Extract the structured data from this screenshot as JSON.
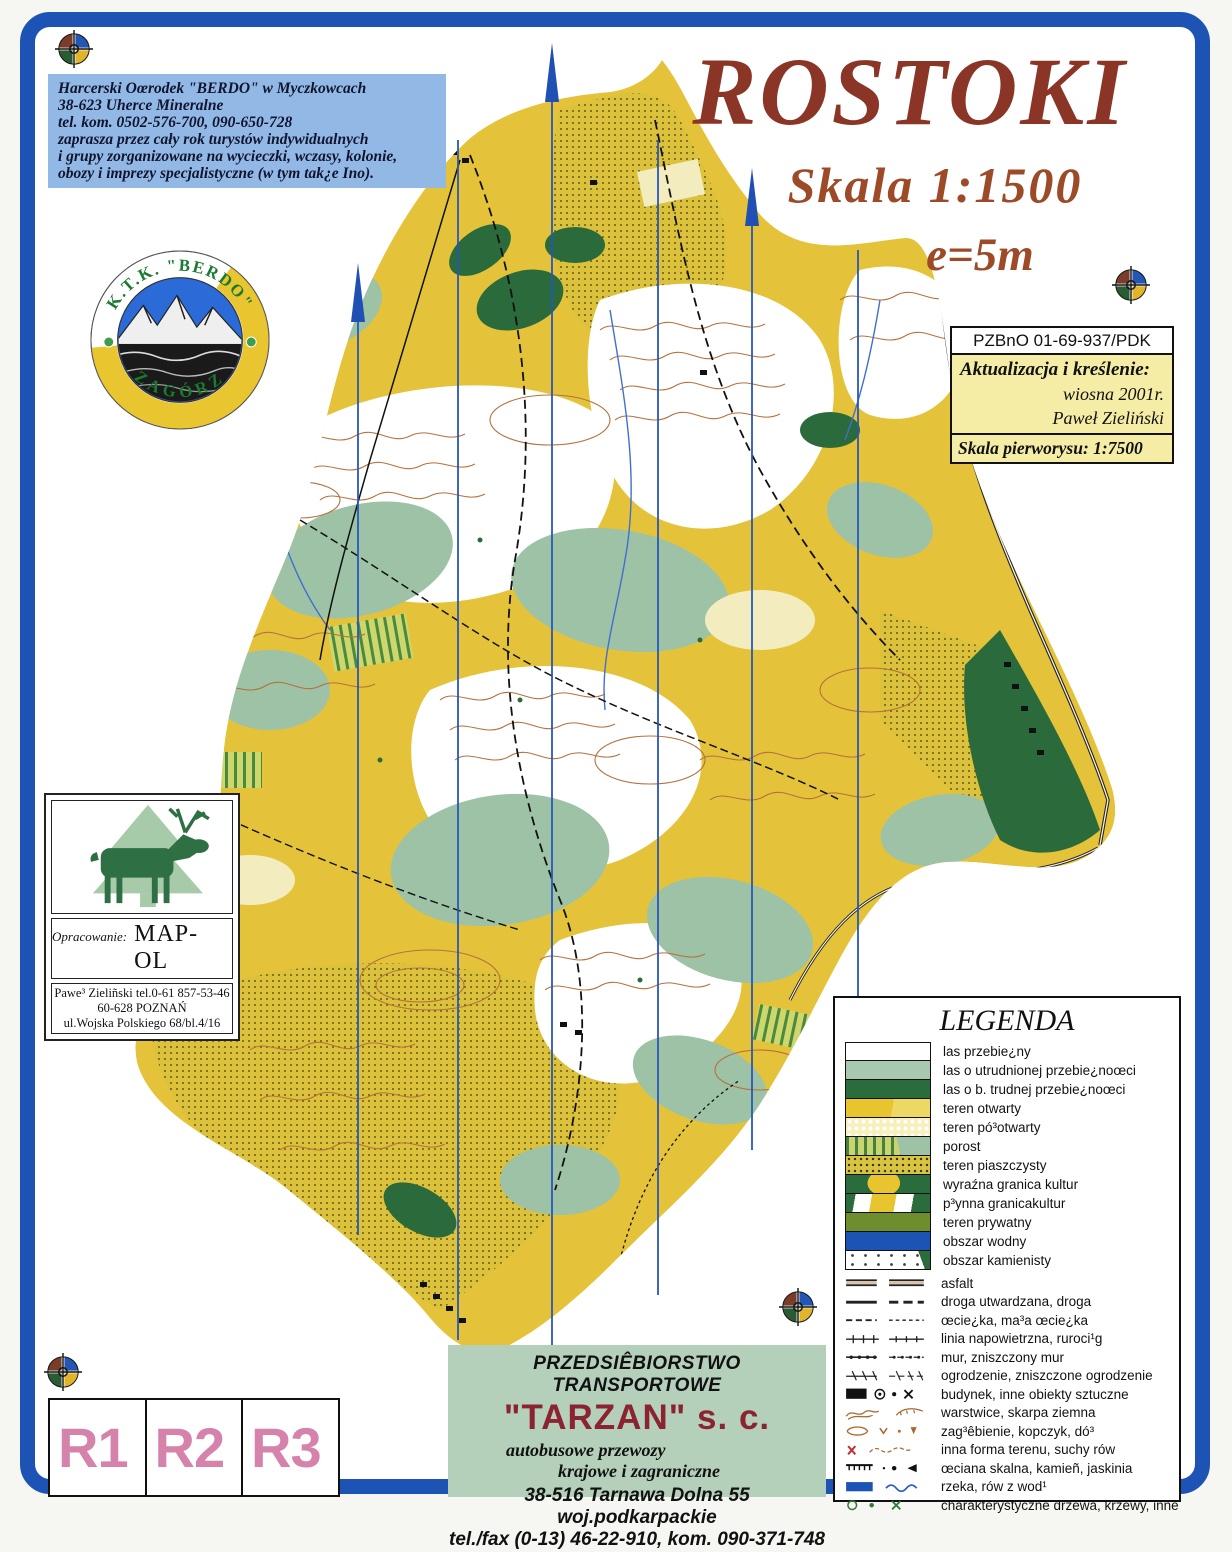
{
  "header": {
    "title": "ROSTOKI",
    "scale": "Skala 1:1500",
    "equidistance": "e=5m"
  },
  "contact_box": {
    "lines": [
      "Harcerski Oœrodek \"BERDO\" w Myczkowcach",
      "38-623 Uherce Mineralne",
      "tel. kom. 0502-576-700, 090-650-728",
      "zaprasza przez cały rok turystów indywidualnych",
      "i grupy zorganizowane na wycieczki, wczasy, kolonie,",
      "obozy i imprezy specjalistyczne (w tym tak¿e Ino)."
    ]
  },
  "club_logo": {
    "top_text": "K.T.K. \"BERDO\"",
    "bottom_text": "ZAGÓRZ"
  },
  "map_info_box": {
    "code": "PZBnO  01-69-937/PDK",
    "update_line1": "Aktualizacja i kreślenie:",
    "update_line2": "wiosna 2001r.",
    "update_line3": "Paweł Zieliński",
    "base_scale": "Skala pierworysu: 1:7500"
  },
  "mapol_box": {
    "label": "Opracowanie:",
    "name": "MAP-OL",
    "address_lines": [
      "Pawe³ Zieliñski tel.0-61 857-53-46",
      "60-628  POZNAŃ",
      "ul.Wojska Polskiego 68/bl.4/16"
    ]
  },
  "legend": {
    "title": "LEGENDA",
    "area_items": [
      "las przebie¿ny",
      "las o utrudnionej przebie¿noœci",
      "las o b. trudnej przebie¿noœci",
      "teren otwarty",
      "teren pó³otwarty",
      "porost",
      "teren piaszczysty",
      "wyraźna granica kultur",
      "p³ynna granicakultur",
      "teren prywatny",
      "obszar wodny",
      "obszar kamienisty"
    ],
    "symbol_items": [
      "asfalt",
      "droga utwardzana, droga",
      "œcie¿ka, ma³a œcie¿ka",
      "linia napowietrzna, ruroci¹g",
      "mur, zniszczony mur",
      "ogrodzenie, zniszczone ogrodzenie",
      "budynek, inne obiekty sztuczne",
      "warstwice, skarpa ziemna",
      "zag³êbienie, kopczyk, dó³",
      "inna forma terenu, suchy rów",
      "œciana skalna, kamieñ, jaskinia",
      "rzeka, rów z wod¹",
      "charakterystyczne drzewa, krzewy, inne"
    ]
  },
  "ad_box": {
    "company_type": "PRZEDSIÊBIORSTWO TRANSPORTOWE",
    "name": "\"TARZAN\" s. c.",
    "service_line1": "autobusowe przewozy",
    "service_line2": "krajowe i zagraniczne",
    "address": "38-516 Tarnawa Dolna 55  woj.podkarpackie",
    "phones": "tel./fax (0-13) 46-22-910, kom. 090-371-748"
  },
  "route_boxes": [
    "R1",
    "R2",
    "R3"
  ],
  "colors": {
    "frame": "#1d53b4",
    "title": "#8b3526",
    "scale_text": "#9c4a28",
    "contact_bg": "#92b9e6",
    "info_bg": "#f5eca6",
    "ad_bg": "#b5d0ba",
    "ad_name": "#8b2430",
    "route_label": "#d583ab",
    "open_land": "#e4c33a",
    "rough_open": "#dcc23a",
    "slow_forest": "#9dc2a6",
    "dense_forest": "#2b6a3b",
    "water": "#1d53b4",
    "contour": "#b5713c",
    "meridian": "#2857b8"
  }
}
